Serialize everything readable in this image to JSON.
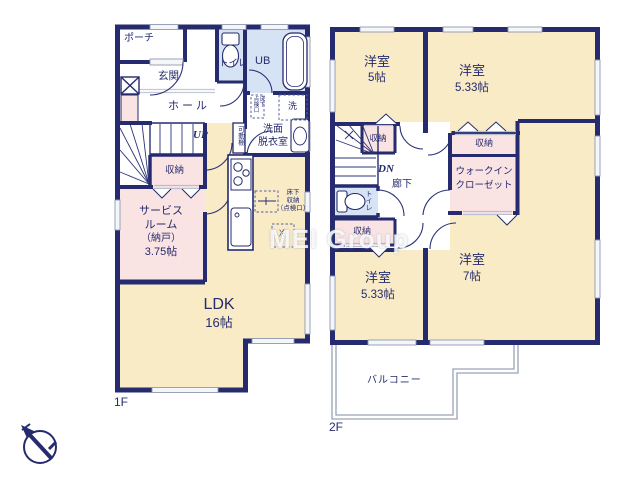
{
  "watermark": "MEI Group",
  "floor1": {
    "label": "1F",
    "porch": "ポーチ",
    "entrance": "玄関",
    "hall": "ホール",
    "toilet": "トイレ",
    "unit_bath": "UB",
    "laundry": "洗",
    "hatch_col_right": "床下",
    "hatch_col_left": "点検口",
    "washroom_line1": "洗面",
    "washroom_line2": "脱衣室",
    "movable_shelf": "可動棚",
    "stairs_up": "UP",
    "storage": "収納",
    "service_room": [
      "サービス",
      "ルーム",
      "（納戸）",
      "3.75帖"
    ],
    "underfloor": [
      "床下",
      "収納",
      "（点検口）"
    ],
    "fridge": "冷",
    "ldk": [
      "LDK",
      "16帖"
    ]
  },
  "floor2": {
    "label": "2F",
    "room5": [
      "洋室",
      "5帖"
    ],
    "room533_top": [
      "洋室",
      "5.33帖"
    ],
    "room533_bottom": [
      "洋室",
      "5.33帖"
    ],
    "room7": [
      "洋室",
      "7帖"
    ],
    "storage": "収納",
    "wic": [
      "ウォークイン",
      "クローゼット"
    ],
    "stairs_down": "DN",
    "corridor": "廊下",
    "toilet": "トイレ",
    "balcony": "バルコニー"
  },
  "colors": {
    "wall_navy": "#252b6e",
    "room_cream": "#f8ebc6",
    "closet_pink": "#fae3e3",
    "bath_blue": "#d6e3f4",
    "window_gray": "#8e98b0"
  }
}
